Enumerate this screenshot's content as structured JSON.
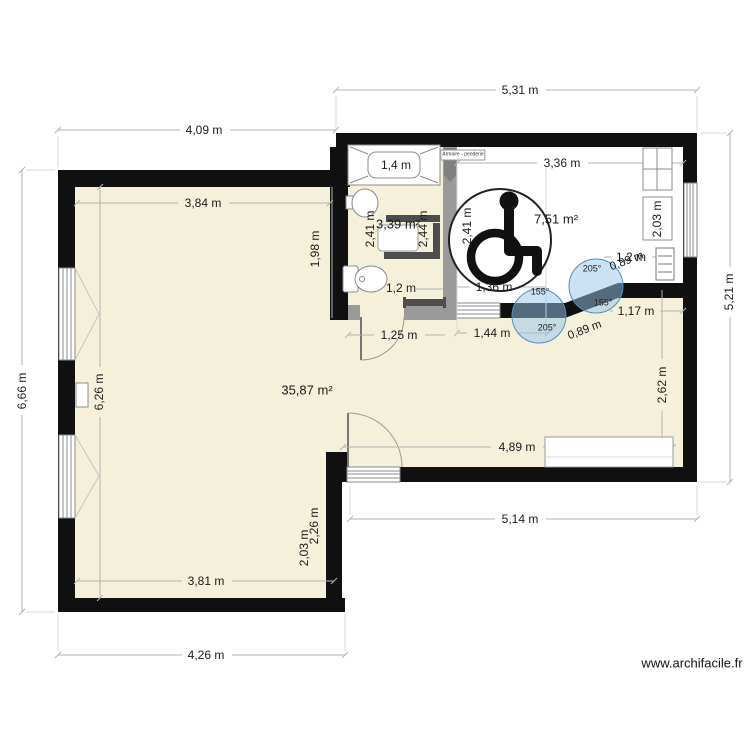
{
  "watermark": "www.archifacile.fr",
  "rooms": {
    "living_area": "35,87 m²",
    "bathroom_area": "3,39 m²",
    "bedroom_area": "7,51 m²"
  },
  "furniture": {
    "wardrobe_label": "Armoire - penderie",
    "bathtub_length": "1,4 m",
    "wardrobe_depth": "2,03 m"
  },
  "dimensions": {
    "top_exterior": "5,31 m",
    "top_left_exterior": "4,09 m",
    "left_exterior": "6,66 m",
    "right_exterior": "5,21 m",
    "bottom_left_exterior": "4,26 m",
    "bottom_right_exterior": "5,14 m",
    "living_top_width": "3,84 m",
    "living_left_height": "6,26 m",
    "living_bottom_width": "3,81 m",
    "bedroom_top_width": "3,36 m",
    "bedroom_height": "2,41 m",
    "bedroom_bottom": "1,36 m",
    "bathroom_height_left": "2,41 m",
    "bathroom_height_right": "2,44 m",
    "bathroom_wall_left": "1,98 m",
    "toilet_zone": "1,2 m",
    "radiator_zone": "1,2 m",
    "below_diagonal_right": "1,17 m",
    "diagonal_upper": "0,89 m",
    "diagonal_lower": "0,89 m",
    "hall_door_zone": "1,25 m",
    "hall_width": "1,44 m",
    "right_room_height": "2,62 m",
    "bottom_room_width": "4,89 m",
    "entry_wall_outer": "2,26 m",
    "entry_wall_inner": "2,03 m"
  },
  "angles": {
    "upper_circle_top": "205°",
    "upper_circle_bottom": "155°",
    "lower_circle_top": "155°",
    "lower_circle_bottom": "205°"
  }
}
